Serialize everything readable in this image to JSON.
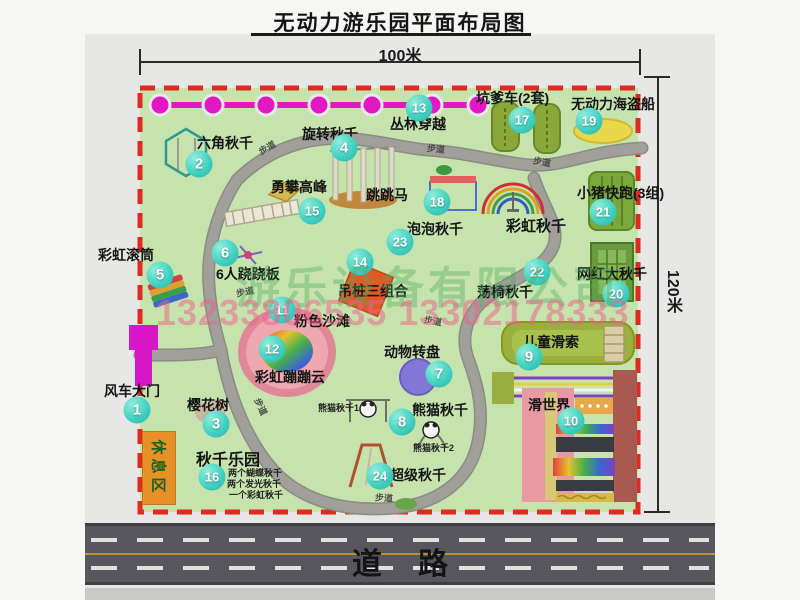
{
  "page": {
    "title": "无动力游乐园平面布局图"
  },
  "dimensions": {
    "width": "100米",
    "height": "120米"
  },
  "road": {
    "label": "道路"
  },
  "rest_area": {
    "label": "休息区"
  },
  "watermark": {
    "company": "游乐设备有限公司",
    "phone": "13233806535 13302178333"
  },
  "colors": {
    "map_green": "#c6e3ae",
    "border_red": "#e02a1e",
    "badge_teal": "#3ecfc0",
    "chain_magenta": "#e318c4",
    "gate_magenta": "#d816c8",
    "rest_orange": "#e89028",
    "road_gray": "#57575d",
    "path_gray": "#a09f99"
  },
  "map": {
    "attractions": [
      {
        "id": 1,
        "name": "风车大门",
        "badge": [
          137,
          410
        ],
        "label": [
          104,
          381
        ]
      },
      {
        "id": 2,
        "name": "六角秋千",
        "badge": [
          199,
          164
        ],
        "label": [
          197,
          133
        ]
      },
      {
        "id": 3,
        "name": "樱花树",
        "badge": [
          216,
          424
        ],
        "label": [
          187,
          395
        ]
      },
      {
        "id": 4,
        "name": "旋转秋千",
        "badge": [
          344,
          148
        ],
        "label": [
          302,
          124
        ]
      },
      {
        "id": 5,
        "name": "彩虹滚筒",
        "badge": [
          160,
          275
        ],
        "label": [
          98,
          245
        ]
      },
      {
        "id": 6,
        "name": "6人跷跷板",
        "badge": [
          225,
          253
        ],
        "label": [
          216,
          264
        ]
      },
      {
        "id": 7,
        "name": "动物转盘",
        "badge": [
          439,
          374
        ],
        "label": [
          384,
          342
        ]
      },
      {
        "id": 8,
        "name": "熊猫秋千",
        "badge": [
          402,
          422
        ],
        "label": [
          412,
          400
        ]
      },
      {
        "id": 9,
        "name": "儿童滑索",
        "badge": [
          529,
          357
        ],
        "label": [
          523,
          332
        ]
      },
      {
        "id": 10,
        "name": "滑世界",
        "badge": [
          571,
          421
        ],
        "label": [
          528,
          395
        ]
      },
      {
        "id": 11,
        "name": "粉色沙滩",
        "badge": [
          282,
          310
        ],
        "label": [
          294,
          311
        ]
      },
      {
        "id": 12,
        "name": "彩虹蹦蹦云",
        "badge": [
          272,
          349
        ],
        "label": [
          255,
          367
        ]
      },
      {
        "id": 13,
        "name": "丛林穿越",
        "badge": [
          419,
          108
        ],
        "label": [
          390,
          114
        ]
      },
      {
        "id": 14,
        "name": "吊桩三组合",
        "badge": [
          360,
          262
        ],
        "label": [
          338,
          281
        ]
      },
      {
        "id": 15,
        "name": "勇攀高峰",
        "badge": [
          312,
          211
        ],
        "label": [
          271,
          177
        ]
      },
      {
        "id": 16,
        "name": "秋千乐园",
        "badge": [
          212,
          477
        ],
        "label": [
          196,
          446
        ],
        "label_size": 16
      },
      {
        "id": 17,
        "name": "坑爹车(2套)",
        "badge": [
          522,
          120
        ],
        "label": [
          476,
          88
        ]
      },
      {
        "id": 18,
        "name": "跳跳马",
        "badge": [
          437,
          202
        ],
        "label": [
          366,
          185
        ]
      },
      {
        "id": 19,
        "name": "无动力海盗船",
        "badge": [
          589,
          121
        ],
        "label": [
          571,
          94
        ]
      },
      {
        "id": 20,
        "name": "网红大秋千",
        "badge": [
          616,
          294
        ],
        "label": [
          577,
          264
        ]
      },
      {
        "id": 21,
        "name": "小猪快跑(3组)",
        "badge": [
          603,
          212
        ],
        "label": [
          577,
          183
        ]
      },
      {
        "id": 22,
        "name": "荡椅秋千",
        "badge": [
          537,
          272
        ],
        "label": [
          477,
          282
        ]
      },
      {
        "id": 23,
        "name": "泡泡秋千",
        "badge": [
          400,
          242
        ],
        "label": [
          407,
          219
        ]
      },
      {
        "id": 24,
        "name": "超级秋千",
        "badge": [
          380,
          476
        ],
        "label": [
          390,
          465
        ]
      }
    ],
    "extra_labels": [
      {
        "text": "彩虹秋千",
        "x": 506,
        "y": 215,
        "size": 15,
        "kind": "attr"
      },
      {
        "text": "熊猫秋千1",
        "x": 318,
        "y": 401,
        "size": 9,
        "kind": "small"
      },
      {
        "text": "熊猫秋千2",
        "x": 413,
        "y": 441,
        "size": 9,
        "kind": "small"
      },
      {
        "text": "两个蝴蝶秋千",
        "x": 228,
        "y": 466,
        "size": 9,
        "kind": "small"
      },
      {
        "text": "两个发光秋千",
        "x": 227,
        "y": 477,
        "size": 9,
        "kind": "small"
      },
      {
        "text": "一个彩虹秋千",
        "x": 229,
        "y": 488,
        "size": 9,
        "kind": "small"
      },
      {
        "text": "步道",
        "x": 258,
        "y": 141,
        "size": 9,
        "rot": -30,
        "kind": "path"
      },
      {
        "text": "步道",
        "x": 427,
        "y": 142,
        "size": 9,
        "rot": 6,
        "kind": "path"
      },
      {
        "text": "步道",
        "x": 533,
        "y": 155,
        "size": 9,
        "rot": 10,
        "kind": "path"
      },
      {
        "text": "步道",
        "x": 236,
        "y": 285,
        "size": 9,
        "rot": -12,
        "kind": "path"
      },
      {
        "text": "步道",
        "x": 424,
        "y": 314,
        "size": 9,
        "rot": 10,
        "kind": "path"
      },
      {
        "text": "步道",
        "x": 252,
        "y": 400,
        "size": 9,
        "rot": 65,
        "kind": "path"
      },
      {
        "text": "步道",
        "x": 375,
        "y": 491,
        "size": 9,
        "rot": 4,
        "kind": "path"
      }
    ]
  }
}
